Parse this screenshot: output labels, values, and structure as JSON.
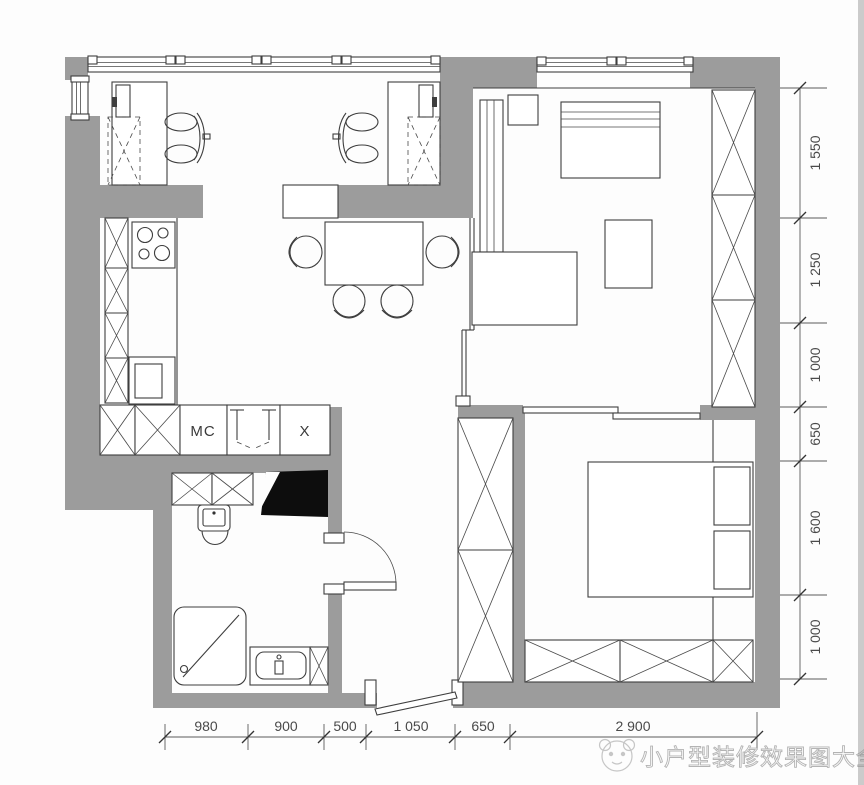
{
  "plan": {
    "labels": {
      "mc": "MC",
      "x": "X"
    },
    "dimensions_right": [
      "1 550",
      "1 250",
      "1 000",
      "650",
      "1 600",
      "1 000"
    ],
    "dimensions_bottom": [
      "980",
      "900",
      "500",
      "1 050",
      "650",
      "2 900"
    ],
    "watermark": {
      "text": "小户型装修效果图大全"
    },
    "colors": {
      "wall": "#9c9c9c",
      "line": "#3e3e3e",
      "dimension_text": "#4a4a4a",
      "watermark_stroke": "#b3b3b3",
      "background": "#fdfdfd",
      "shaft_fill": "#0d0d0d"
    }
  }
}
